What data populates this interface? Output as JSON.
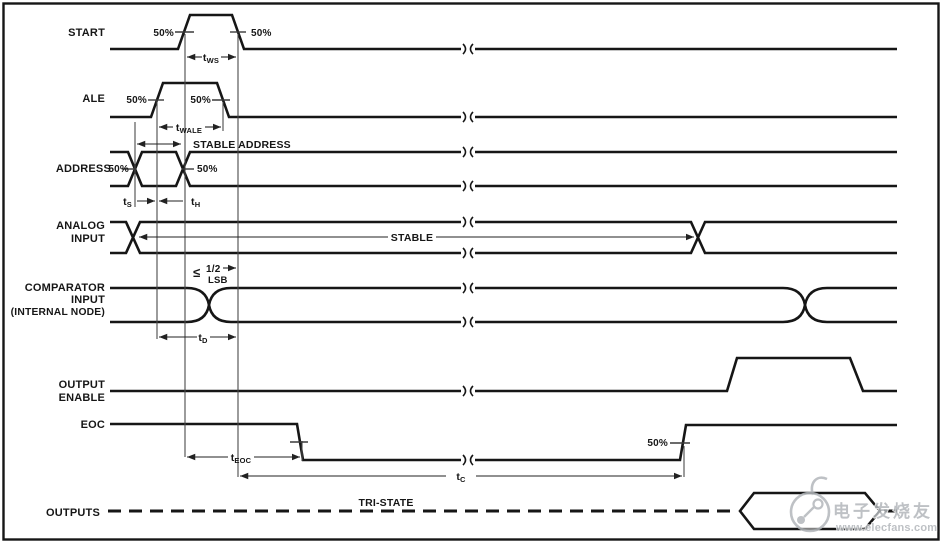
{
  "signals": {
    "start": "START",
    "ale": "ALE",
    "address": "ADDRESS",
    "analog_1": "ANALOG",
    "analog_2": "INPUT",
    "comparator_1": "COMPARATOR",
    "comparator_2": "INPUT",
    "comparator_3": "(INTERNAL NODE)",
    "output_enable_1": "OUTPUT",
    "output_enable_2": "ENABLE",
    "eoc": "EOC",
    "outputs": "OUTPUTS"
  },
  "labels": {
    "pct50": "50%",
    "stable_address": "STABLE ADDRESS",
    "stable": "STABLE",
    "tri_state": "TRI-STATE",
    "lsb_le": "≤",
    "lsb_num": "1/2",
    "lsb_txt": "LSB"
  },
  "timings": {
    "tws": {
      "base": "t",
      "sub": "WS"
    },
    "twale": {
      "base": "t",
      "sub": "WALE"
    },
    "ts": {
      "base": "t",
      "sub": "S"
    },
    "th": {
      "base": "t",
      "sub": "H"
    },
    "td": {
      "base": "t",
      "sub": "D"
    },
    "teoc": {
      "base": "t",
      "sub": "EOC"
    },
    "tc": {
      "base": "t",
      "sub": "C"
    }
  },
  "watermark": {
    "brand": "电子发烧友",
    "url": "www.elecfans.com"
  },
  "colors": {
    "waveform": "#161616",
    "reference": "#4a4a4a",
    "watermark": "#b3b7bb",
    "background": "#ffffff"
  }
}
